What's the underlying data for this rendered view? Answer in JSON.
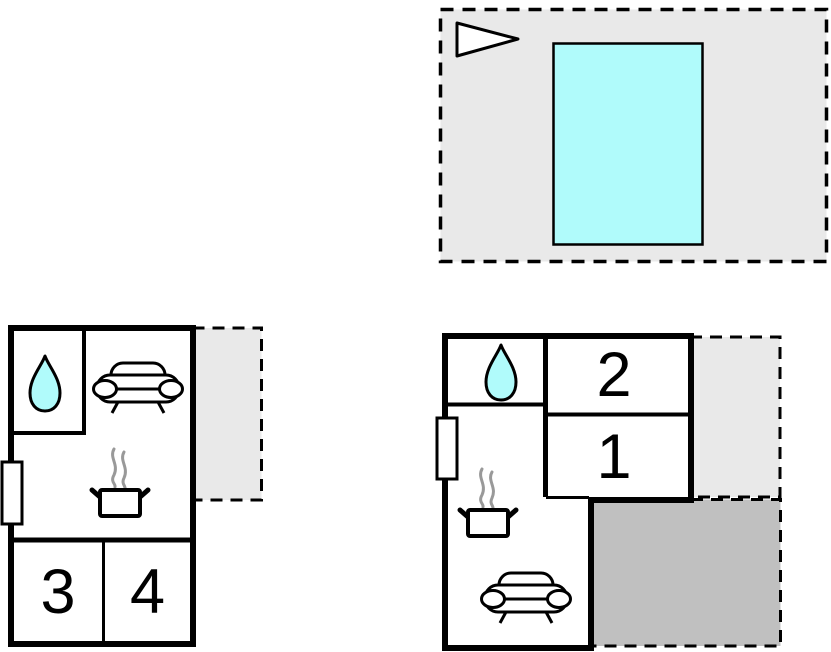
{
  "colors": {
    "wall": "#000000",
    "room_fill": "#ffffff",
    "water": "#b0fbfb",
    "terrace_light": "#e9e9e9",
    "terrace_dark": "#c0c0c0",
    "steam": "#999999"
  },
  "site_plan": {
    "icons": [
      {
        "name": "direction-arrow-icon"
      },
      {
        "name": "swimming-pool"
      }
    ]
  },
  "left_plan": {
    "rooms": [
      {
        "id": "bedroom-3",
        "label": "3"
      },
      {
        "id": "bedroom-4",
        "label": "4"
      }
    ],
    "icons": [
      {
        "name": "water-drop-icon"
      },
      {
        "name": "sofa-icon"
      },
      {
        "name": "cooking-pot-icon"
      }
    ],
    "features": [
      {
        "name": "window-door"
      },
      {
        "name": "terrace"
      }
    ]
  },
  "right_plan": {
    "rooms": [
      {
        "id": "bedroom-2",
        "label": "2"
      },
      {
        "id": "bedroom-1",
        "label": "1"
      }
    ],
    "icons": [
      {
        "name": "water-drop-icon"
      },
      {
        "name": "cooking-pot-icon"
      },
      {
        "name": "sofa-icon"
      }
    ],
    "features": [
      {
        "name": "window-door"
      },
      {
        "name": "terrace-upper"
      },
      {
        "name": "terrace-lower"
      }
    ]
  }
}
